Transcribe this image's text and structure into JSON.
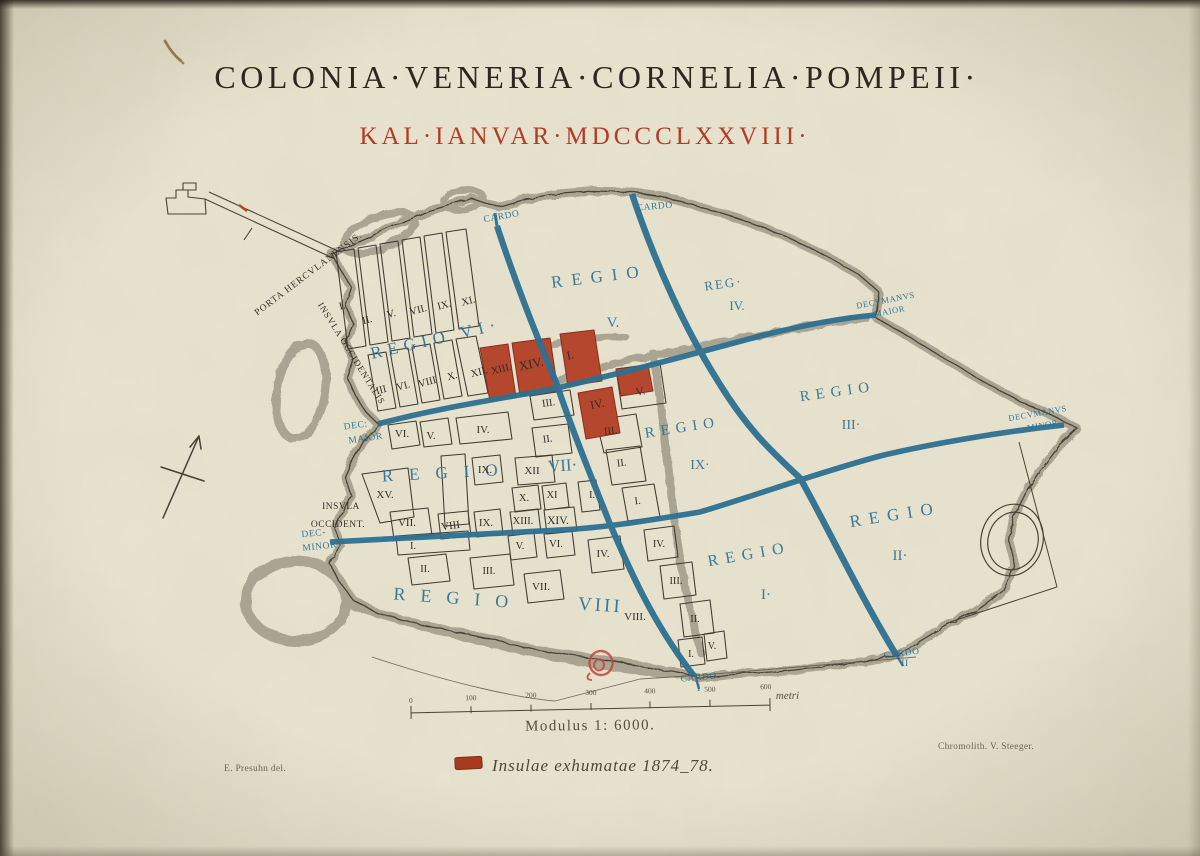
{
  "plate": {
    "title": "COLONIA·VENERIA·CORNELIA·POMPEII·",
    "subtitle": "KAL·IANVAR·MDCCCLXXVIII·"
  },
  "colors": {
    "paper": "#e9e5d1",
    "map_ink": "#3a342b",
    "title_ink": "#2c2820",
    "date_red": "#b23a26",
    "excavated_red": "#b4472e",
    "street_blue": "#2d7191",
    "label_blue": "#2f7293",
    "stamp_red": "#c5473f"
  },
  "regions": {
    "vi": "REGIO VI·",
    "v_word": "REGIO",
    "v_num": "V.",
    "iv_word": "REG·",
    "iv_num": "IV.",
    "iii_word": "REGIO",
    "iii_num": "III·",
    "ix_word": "REGIO",
    "ix_num": "IX·",
    "vii_word": "REGIO",
    "vii_num": "VII·",
    "viii_word": "REGIO",
    "viii_num": "VIII",
    "i_word": "REGIO",
    "i_num": "I·",
    "ii_word": "REGIO",
    "ii_num": "II·"
  },
  "streets": {
    "cardo_nw": "CARDO",
    "cardo_n": "CARDO",
    "cardo_i_word": "CARDO",
    "cardo_i_num": "I",
    "cardo_ii_word": "CARDO",
    "cardo_ii_num": "II",
    "decumanus_maior_1": "DECVMANVS",
    "decumanus_maior_2": "MAIOR",
    "decumanus_minor_1": "DECVMANVS",
    "decumanus_minor_2": "MINOR",
    "dec_maior_w_1": "DEC:",
    "dec_maior_w_2": "MAIOR",
    "dec_minor_w_1": "DEC-",
    "dec_minor_w_2": "MINOR"
  },
  "landmarks": {
    "porta": "PORTA HERCVLANENSIS.",
    "insula_occidentalis": "INSVLA OCCIDENTALIS",
    "insula_occident_1": "INSVLA",
    "insula_occident_2": "OCCIDENT."
  },
  "insulae": [
    {
      "t": "I."
    },
    {
      "t": "II."
    },
    {
      "t": "V."
    },
    {
      "t": "VII."
    },
    {
      "t": "IX."
    },
    {
      "t": "XI."
    },
    {
      "t": "III"
    },
    {
      "t": "VI."
    },
    {
      "t": "VIII"
    },
    {
      "t": "X."
    },
    {
      "t": "XII."
    },
    {
      "t": "XIII."
    },
    {
      "t": "XIV."
    },
    {
      "t": "I."
    },
    {
      "t": "IV."
    },
    {
      "t": "V."
    },
    {
      "t": "III."
    },
    {
      "t": "III."
    },
    {
      "t": "II."
    },
    {
      "t": "I."
    },
    {
      "t": "II."
    },
    {
      "t": "VI."
    },
    {
      "t": "V."
    },
    {
      "t": "IV."
    },
    {
      "t": "IX."
    },
    {
      "t": "XII"
    },
    {
      "t": "XV."
    },
    {
      "t": "X."
    },
    {
      "t": "XI"
    },
    {
      "t": "I."
    },
    {
      "t": "XIII."
    },
    {
      "t": "XIV."
    },
    {
      "t": "VII."
    },
    {
      "t": "VIII"
    },
    {
      "t": "IX."
    },
    {
      "t": "I."
    },
    {
      "t": "V."
    },
    {
      "t": "VI."
    },
    {
      "t": "IV."
    },
    {
      "t": "II."
    },
    {
      "t": "III."
    },
    {
      "t": "VII."
    },
    {
      "t": "VIII."
    },
    {
      "t": "IV."
    },
    {
      "t": "III."
    },
    {
      "t": "II."
    },
    {
      "t": "I."
    },
    {
      "t": "V."
    }
  ],
  "scale": {
    "ticks": [
      "0",
      "100",
      "200",
      "300",
      "400",
      "500",
      "600"
    ],
    "unit": "metri",
    "modulus": "Modulus 1: 6000."
  },
  "legend": {
    "text": "Insulae exhumatae 1874_78."
  },
  "credits": {
    "left": "E. Presuhn del.",
    "right": "Chromolith. V. Steeger."
  }
}
